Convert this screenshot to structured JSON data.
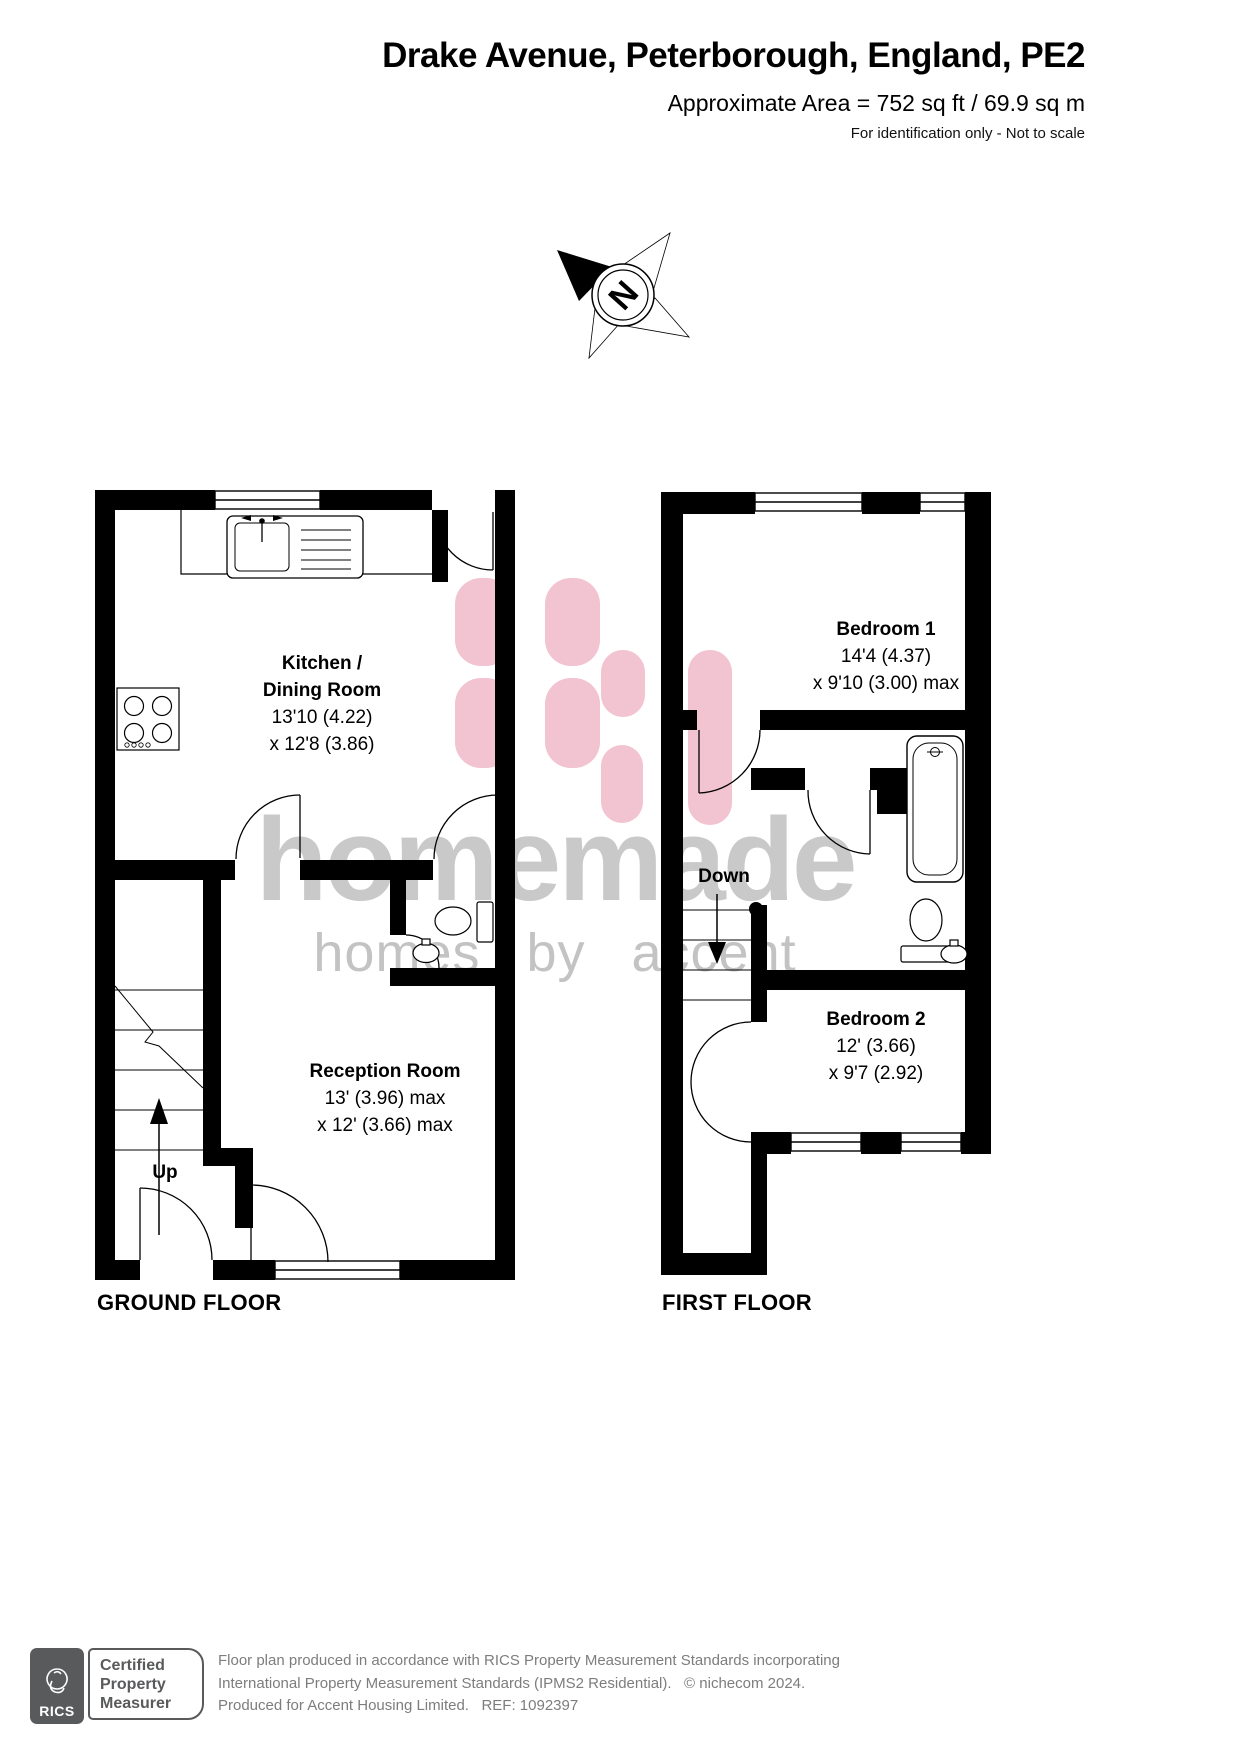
{
  "header": {
    "title": "Drake Avenue, Peterborough, England, PE2",
    "area": "Approximate Area = 752 sq ft / 69.9 sq m",
    "disclaimer": "For identification only - Not to scale"
  },
  "compass": {
    "north": "N"
  },
  "watermark": {
    "brand": "homemade",
    "tagline": "homes by accent"
  },
  "colors": {
    "wall": "#000000",
    "logo_pink": "#f2c3d0",
    "watermark_gray": "#c9c9c9"
  },
  "ground_floor": {
    "caption": "GROUND FLOOR",
    "stairs_label": "Up",
    "kitchen": {
      "line1": "Kitchen /",
      "line2": "Dining Room",
      "dim1": "13'10 (4.22)",
      "dim2": "x 12'8 (3.86)"
    },
    "reception": {
      "line1": "Reception Room",
      "dim1": "13' (3.96) max",
      "dim2": "x 12' (3.66) max"
    }
  },
  "first_floor": {
    "caption": "FIRST FLOOR",
    "stairs_label": "Down",
    "bedroom1": {
      "line1": "Bedroom 1",
      "dim1": "14'4 (4.37)",
      "dim2": "x 9'10 (3.00) max"
    },
    "bedroom2": {
      "line1": "Bedroom 2",
      "dim1": "12' (3.66)",
      "dim2": "x 9'7 (2.92)"
    }
  },
  "footer": {
    "certification": {
      "org": "RICS",
      "line1": "Certified",
      "line2": "Property",
      "line3": "Measurer"
    },
    "line1": "Floor plan produced in accordance with RICS Property Measurement Standards incorporating",
    "line2": "International Property Measurement Standards (IPMS2 Residential).   © nichecom 2024.",
    "line3": "Produced for Accent Housing Limited.   REF: 1092397"
  }
}
